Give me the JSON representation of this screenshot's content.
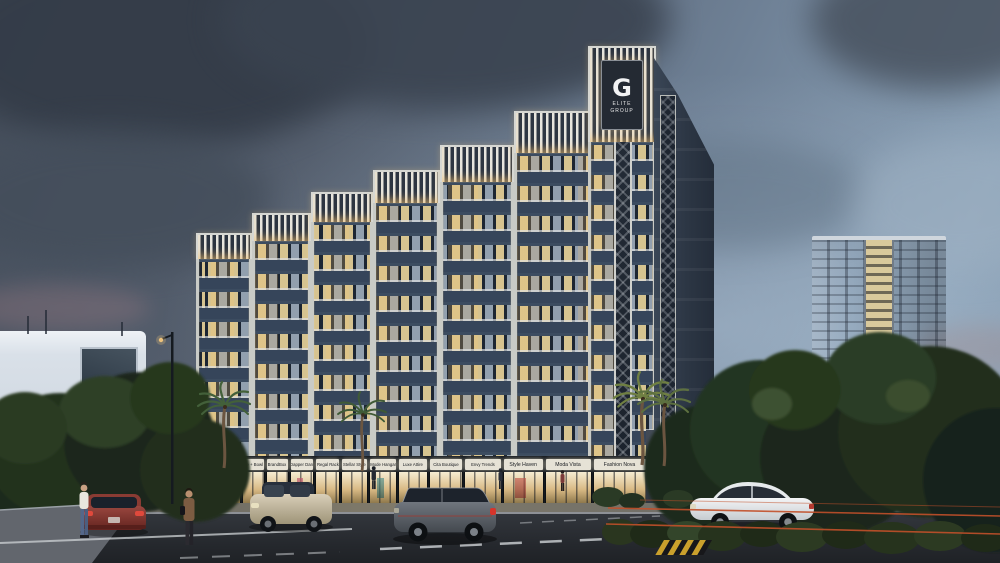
{
  "scene": {
    "brand": {
      "initial": "G",
      "line1": "ELITE",
      "line2": "GROUP"
    },
    "shops": [
      {
        "name": "Paper Tale"
      },
      {
        "name": "Vibe Look"
      },
      {
        "name": "Be + Bowl"
      },
      {
        "name": "BrandBox"
      },
      {
        "name": "Dapper Dan"
      },
      {
        "name": "Regal Rack"
      },
      {
        "name": "Stellar Style"
      },
      {
        "name": "Mode Hangar"
      },
      {
        "name": "Luxe Attire"
      },
      {
        "name": "Cita Boutique"
      },
      {
        "name": "Envy Trends"
      },
      {
        "name": "Style Haven"
      },
      {
        "name": "Moda Vista"
      },
      {
        "name": "Fashion Nova"
      }
    ],
    "colors": {
      "sky_dark": "#3a4350",
      "sky_light": "#8aa0b5",
      "facade": "#4a5a6e",
      "facade_dark": "#2c3644",
      "pilaster": "#d6d7d2",
      "warm_window": "#eed696",
      "sign_panel": "#e6e2d6",
      "fascia": "#14191f",
      "fence_wire": "#c2502a",
      "road": "#25282d",
      "foliage": "#24331f"
    }
  }
}
